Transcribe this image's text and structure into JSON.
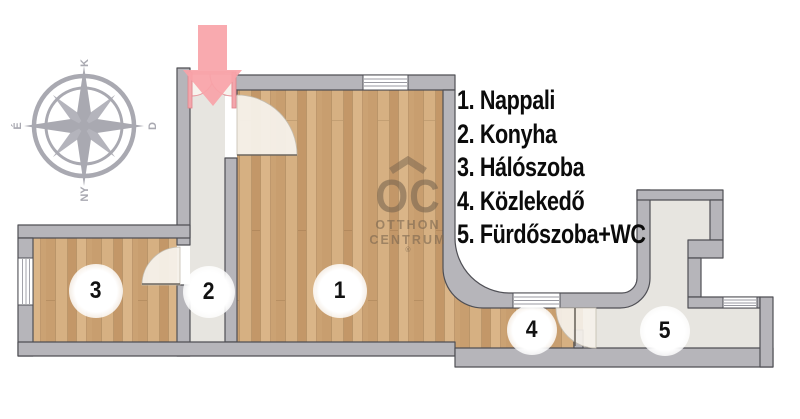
{
  "legend": {
    "items": [
      {
        "label": "1. Nappali"
      },
      {
        "label": "2. Konyha"
      },
      {
        "label": "3. Hálószoba"
      },
      {
        "label": "4. Közlekedő"
      },
      {
        "label": "5. Fürdőszoba+WC"
      }
    ]
  },
  "room_badges": {
    "nappali": "1",
    "konyha": "2",
    "haloszoba": "3",
    "kozlekedo": "4",
    "furdoszoba": "5"
  },
  "compass": {
    "top": "K",
    "right": "D",
    "bottom": "NY",
    "left": "É"
  },
  "logo": {
    "initials": "OC",
    "line1": "OTTHON",
    "line2": "CENTRUM",
    "registered": "®"
  },
  "icons": {
    "entrance_arrow": "down-arrow",
    "compass": "compass-rose"
  },
  "colors": {
    "ink": "#0b0b0b",
    "wood": "#cfa87a",
    "wall_gray": "#b6b5ba",
    "wall_outline": "#4f4f55",
    "floor_light": "#e7e5e0",
    "accent_pink": "#f8a3a8",
    "door_pink": "#e0838b",
    "compass_gray": "#a9a9b1",
    "logo_brown": "rgba(125,104,80,0.62)"
  }
}
